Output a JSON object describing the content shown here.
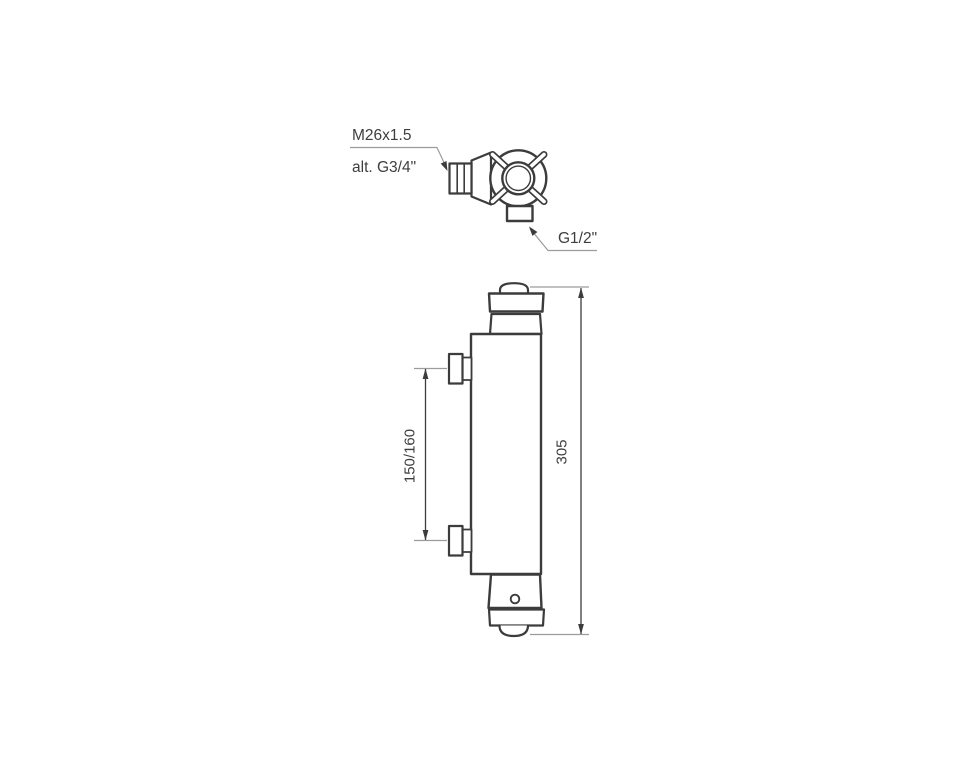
{
  "drawing": {
    "top_view": {
      "thread_label": "M26x1.5",
      "alt_thread_label": "alt. G3/4\"",
      "outlet_label": "G1/2\""
    },
    "front_view": {
      "inlet_spacing_label": "150/160",
      "height_label": "305"
    },
    "colors": {
      "background": "#ffffff",
      "line": "#3c3c3c",
      "extension_line": "#9c9c9c",
      "text": "#3e3e3e"
    }
  }
}
